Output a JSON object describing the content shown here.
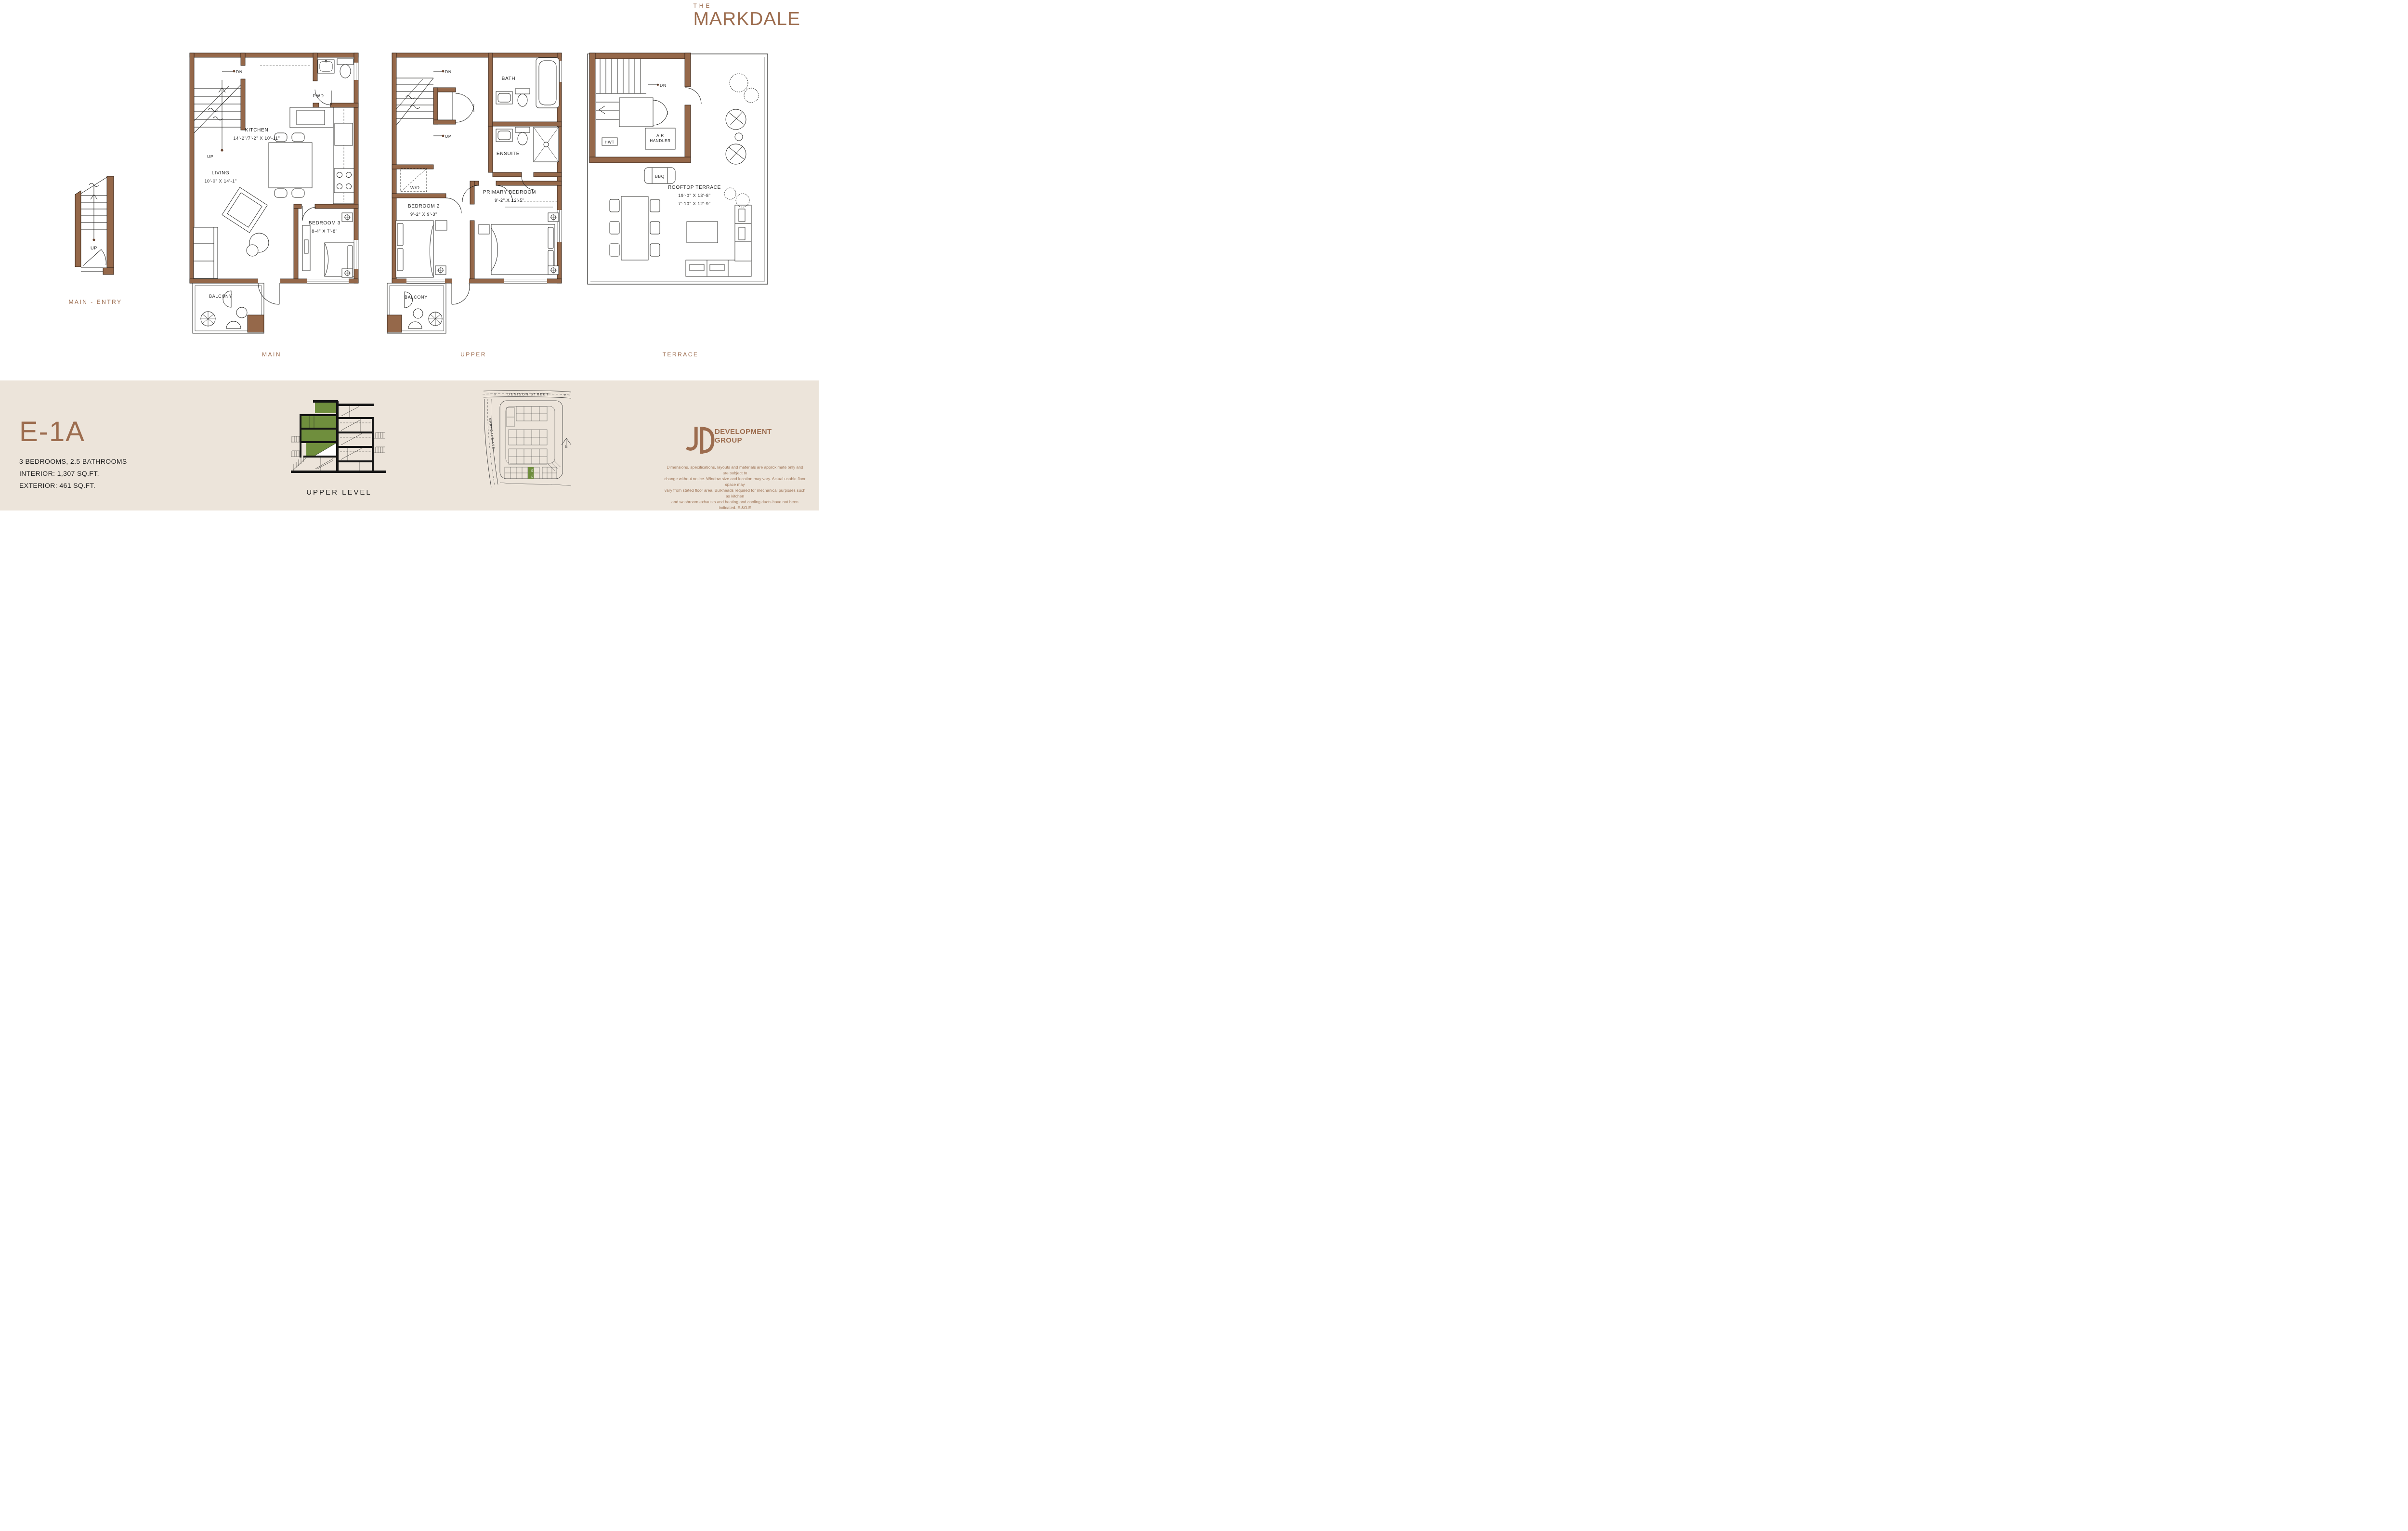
{
  "brand": {
    "the": "THE",
    "name": "MARKDALE"
  },
  "unit": {
    "code": "E-1A",
    "specs": [
      "3 BEDROOMS, 2.5 BATHROOMS",
      "INTERIOR: 1,307 SQ.FT.",
      "EXTERIOR: 461 SQ.FT."
    ]
  },
  "plans": {
    "entry": {
      "caption": "MAIN - ENTRY",
      "labels": {
        "up": "UP"
      }
    },
    "main": {
      "caption": "MAIN",
      "labels": {
        "dn": "DN",
        "up": "UP",
        "pwd": "PWD",
        "kitchen": "KITCHEN",
        "kitchen_dims": "14'-2\"/7'-2\" X 10'-11\"",
        "living": "LIVING",
        "living_dims": "10'-0\" X 14'-1\"",
        "bedroom3": "BEDROOM 3",
        "bedroom3_dims": "8-4\" X 7'-8\"",
        "balcony": "BALCONY"
      }
    },
    "upper": {
      "caption": "UPPER",
      "labels": {
        "dn": "DN",
        "up": "UP",
        "bath": "BATH",
        "ensuite": "ENSUITE",
        "wd": "W/D",
        "bedroom2": "BEDROOM 2",
        "bedroom2_dims": "9'-2\" X 9'-3\"",
        "primary": "PRIMARY BEDROOM",
        "primary_dims": "9'-2\" X 12'-5\"",
        "balcony": "BALCONY"
      }
    },
    "terrace": {
      "caption": "TERRACE",
      "labels": {
        "dn": "DN",
        "hwt": "HWT",
        "air1": "AIR",
        "air2": "HANDLER",
        "bbq": "BBQ",
        "rooftop": "ROOFTOP TERRACE",
        "rooftop_dims1": "19'-0\" X 13'-8\"",
        "rooftop_dims2": "7'-10\" X 12'-9\""
      }
    }
  },
  "section": {
    "caption": "UPPER LEVEL"
  },
  "sitemap": {
    "street_top": "DENISON STREET",
    "street_left": "MARYDALE AVE",
    "north": "N",
    "unit_a": "415",
    "unit_b": "418",
    "arrow": "»"
  },
  "developer": {
    "line1": "DEVELOPMENT",
    "line2": "GROUP"
  },
  "disclaimer": [
    "Dimensions, specifications, layouts and materials are approximate only and are subject to",
    "change without notice. Window size and location may vary. Actual usable floor space may",
    "vary from stated floor area. Bulkheads required for mechanical purposes such as kitchen",
    "and washroom exhausts and heating and cooling ducts have not been indicated. E.&O.E"
  ],
  "colors": {
    "accent": "#9c6c4e",
    "wall": "#95684a",
    "band": "#ece4da",
    "green": "#6f8e3d",
    "ink": "#1d1d1d",
    "disclaimer_text": "#a1795c"
  }
}
